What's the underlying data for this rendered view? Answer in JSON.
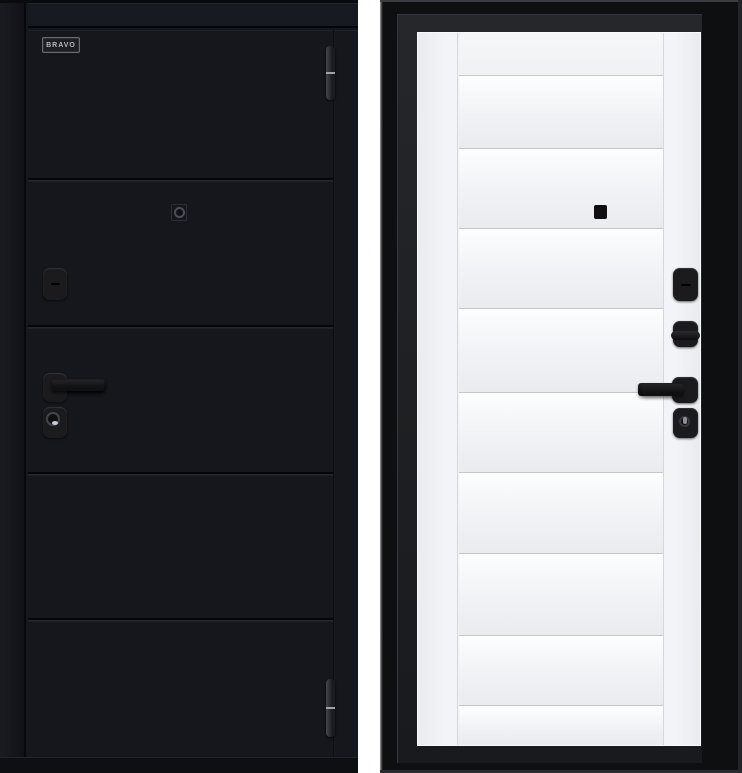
{
  "branding": {
    "logo_text": "BRAVO"
  },
  "scene": {
    "description": "Steel entry door shown from both sides: black exterior leaf and white paneled interior leaf in a black frame",
    "background_color": "#ffffff",
    "left_door": {
      "side": "exterior",
      "finish_color": "#15171c",
      "panel_rows": 5,
      "hardware": {
        "logo_plate": "BRAVO",
        "peephole": "peephole",
        "deadbolt_cover": "deadbolt cover plate",
        "handle": "lever handle",
        "cylinder": "cylinder lock",
        "hinge_count": 2
      }
    },
    "right_door": {
      "side": "interior",
      "leaf_color": "#f1f2f5",
      "frame_color": "#0e0f11",
      "panel_rows": 8,
      "hardware_color": "#1b1b1e",
      "hardware": {
        "peephole_cover": "peephole cover",
        "deadbolt_cover": "deadbolt cover plate",
        "thumbturn": "thumbturn",
        "handle": "lever handle",
        "cylinder": "cylinder lock"
      }
    }
  }
}
